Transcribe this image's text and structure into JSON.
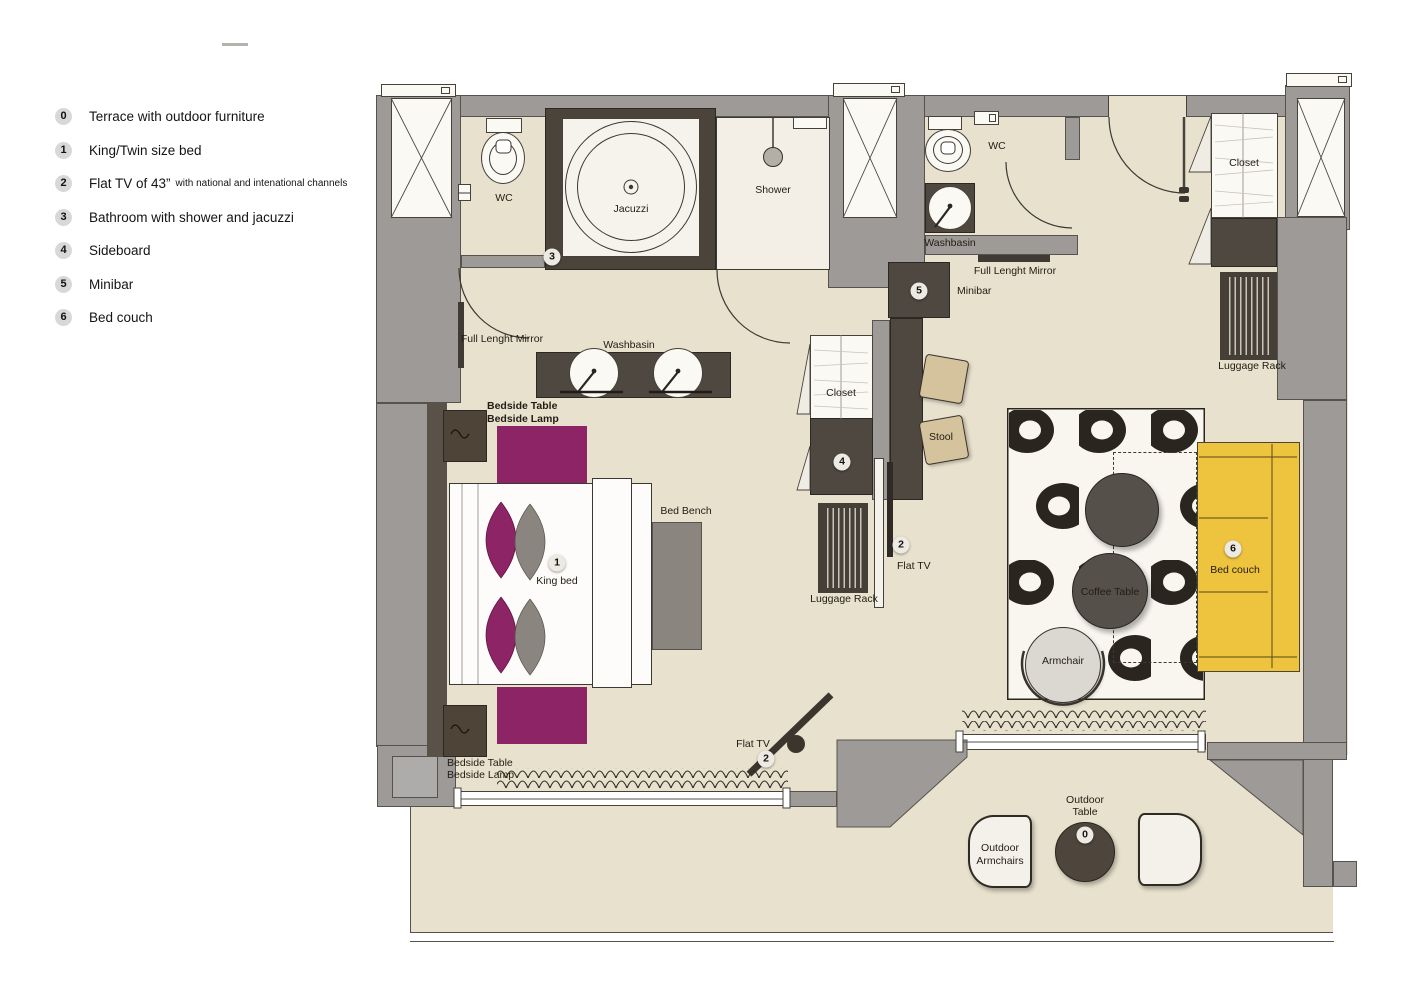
{
  "legend": {
    "items": [
      {
        "num": "0",
        "label": "Terrace with outdoor furniture",
        "sub": ""
      },
      {
        "num": "1",
        "label": "King/Twin size bed",
        "sub": ""
      },
      {
        "num": "2",
        "label": "Flat TV of 43”",
        "sub": "with national and intenational channels"
      },
      {
        "num": "3",
        "label": "Bathroom with shower and jacuzzi",
        "sub": ""
      },
      {
        "num": "4",
        "label": "Sideboard",
        "sub": ""
      },
      {
        "num": "5",
        "label": "Minibar",
        "sub": ""
      },
      {
        "num": "6",
        "label": "Bed couch",
        "sub": ""
      }
    ]
  },
  "plan": {
    "labels": {
      "wc_left": "WC",
      "jacuzzi": "Jacuzzi",
      "shower": "Shower",
      "washbasin_main": "Washbasin",
      "full_length_mirror_left": "Full Lenght Mirror",
      "bedside_table": "Bedside Table",
      "bedside_lamp": "Bedside Lamp",
      "king_bed": "King bed",
      "bed_bench": "Bed Bench",
      "luggage_rack_left": "Luggage Rack",
      "flat_tv_wall": "Flat TV",
      "stool": "Stool",
      "closet_mid": "Closet",
      "wc_right": "WC",
      "washbasin_right": "Washbasin",
      "full_length_mirror_right": "Full Lenght Mirror",
      "minibar": "Minibar",
      "closet_entrance": "Closet",
      "luggage_rack_right": "Luggage Rack",
      "coffee_table": "Coffee Table",
      "armchair": "Armchair",
      "bed_couch": "Bed couch",
      "flat_tv_terrace": "Flat TV",
      "outdoor_armchairs_l1": "Outdoor",
      "outdoor_armchairs_l2": "Armchairs",
      "outdoor_table_l1": "Outdoor",
      "outdoor_table_l2": "Table"
    },
    "markers": {
      "terrace": "0",
      "bed": "1",
      "tv_wall": "2",
      "tv_terrace": "2",
      "bathroom": "3",
      "sideboard": "4",
      "minibar": "5",
      "bed_couch": "6"
    }
  },
  "colors": {
    "wall": "#9d9a97",
    "floor": "#e8e1cd",
    "dark_furniture": "#4f4840",
    "accent_purple": "#8c2466",
    "couch_yellow": "#eec33e",
    "rug_dark": "#2b2520",
    "stool_tan": "#d5c39d"
  }
}
